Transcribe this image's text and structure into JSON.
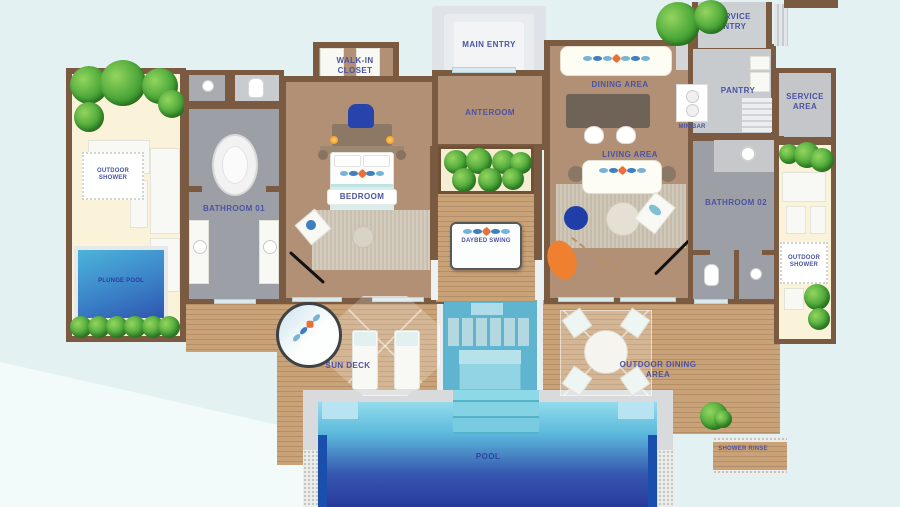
{
  "labels": {
    "main_entry": "MAIN ENTRY",
    "service_entry": "SERVICE ENTRY",
    "walk_in_closet": "WALK-IN CLOSET",
    "anteroom": "ANTEROOM",
    "dining_area": "DINING AREA",
    "pantry": "PANTRY",
    "minibar": "MINIBAR",
    "service_area": "SERVICE AREA",
    "living_area": "LIVING AREA",
    "bedroom": "BEDROOM",
    "bathroom_01": "BATHROOM 01",
    "bathroom_02": "BATHROOM 02",
    "outdoor_shower_left": "OUTDOOR SHOWER",
    "outdoor_shower_right": "OUTDOOR SHOWER",
    "plunge_pool": "PLUNGE POOL",
    "daybed_swing": "DAYBED SWING",
    "sun_deck": "SUN DECK",
    "outdoor_dining_area": "OUTDOOR DINING AREA",
    "pool": "POOL",
    "shower_rinse": "SHOWER RINSE"
  },
  "colors": {
    "background": "#e3f1f3",
    "wall": "#7a5a40",
    "deck_wood": "#c9a277",
    "interior_floor": "#b19076",
    "bathroom_floor": "#9ca0a6",
    "service_floor": "#c8cbce",
    "sand": "#fbf2da",
    "pool_light": "#8fd8ea",
    "pool_dark": "#27379b",
    "label_text": "#4b53a2",
    "foliage": "#4aa638",
    "accent_orange": "#ee7e33",
    "accent_blue": "#2744ad"
  }
}
